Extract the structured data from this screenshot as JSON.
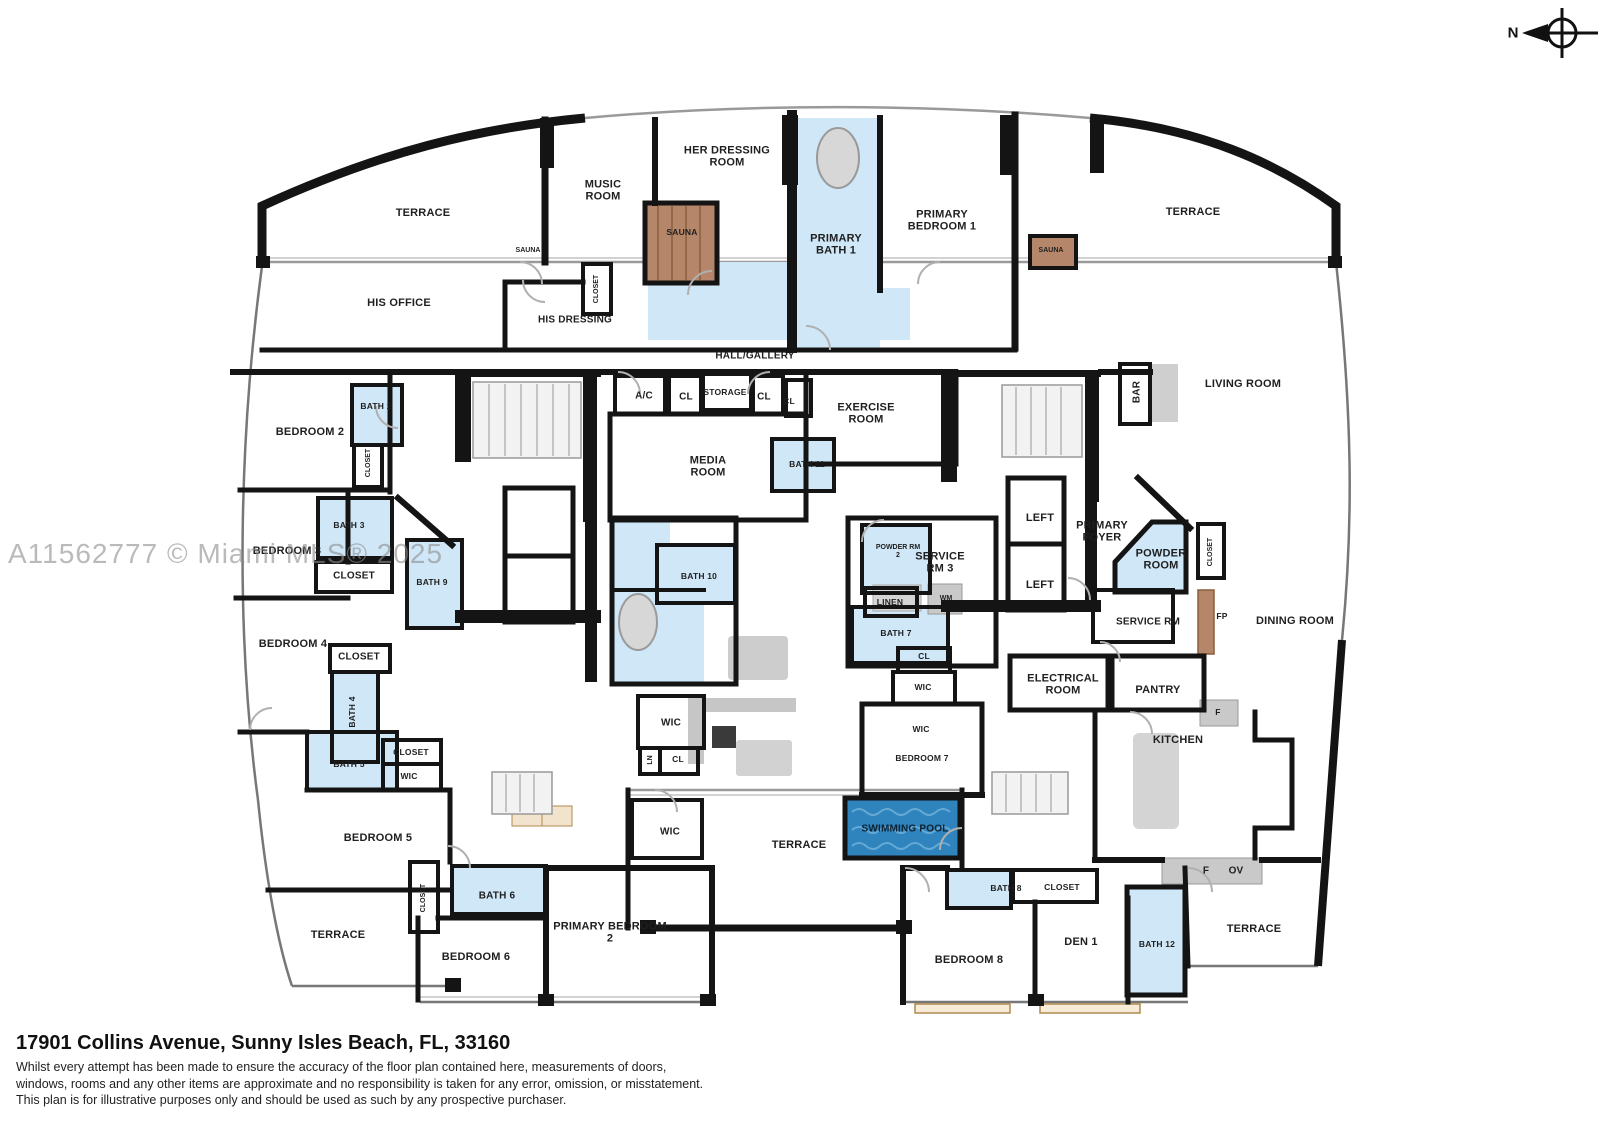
{
  "watermark": "A11562777 © Miami MLS® 2025",
  "compass": {
    "north_label": "N"
  },
  "footer": {
    "address": "17901 Collins Avenue, Sunny Isles Beach, FL, 33160",
    "disclaimer_line1": "Whilst every attempt has been made to ensure the accuracy of the floor plan contained here, measurements of doors,",
    "disclaimer_line2": "windows, rooms and any other items are approximate and no responsibility is taken for any error, omission, or misstatement.",
    "disclaimer_line3": "This plan is for illustrative purposes only and should be used as such by any prospective purchaser."
  },
  "colors": {
    "wall": "#141414",
    "bath_blue": "#cfe7f7",
    "sauna_brown": "#b5866a",
    "pool_blue": "#2f84bd",
    "fixture_gray": "#c9c9c9",
    "wood_tan": "#c9a063"
  },
  "labels": {
    "terrace_top_left": "TERRACE",
    "music_room": "MUSIC ROOM",
    "her_dressing_room": "HER DRESSING ROOM",
    "sauna_center": "SAUNA",
    "primary_bath_1": "PRIMARY BATH 1",
    "primary_bedroom_1": "PRIMARY BEDROOM 1",
    "sauna_right": "SAUNA",
    "terrace_top_right": "TERRACE",
    "sauna_left": "SAUNA",
    "his_office": "HIS OFFICE",
    "closet_his_dressing": "CLOSET",
    "his_dressing": "HIS DRESSING",
    "hall_gallery": "HALL/GALLERY",
    "bedroom_2": "BEDROOM 2",
    "bath_2_small": "BATH 2",
    "closet_bedroom_2": "CLOSET",
    "ac": "A/C",
    "cl_1": "CL",
    "storage": "STORAGE",
    "cl_2": "CL",
    "cl_3": "CL",
    "exercise_room": "EXERCISE ROOM",
    "bar": "BAR",
    "living_room": "LIVING ROOM",
    "media_room": "MEDIA ROOM",
    "bath_11": "BATH 11",
    "bedroom_3": "BEDROOM 3",
    "bath_3": "BATH 3",
    "closet_bedroom_3": "CLOSET",
    "bath_9": "BATH 9",
    "bath_10": "BATH 10",
    "powder_rm_2": "POWDER RM 2",
    "service_rm_3": "SERVICE RM 3",
    "lift_upper": "LEFT",
    "primary_foyer": "PRIMARY FOYER",
    "lift_lower": "LEFT",
    "powder_room": "POWDER ROOM",
    "closet_powder": "CLOSET",
    "bedroom_4": "BEDROOM 4",
    "closet_bedroom_4": "CLOSET",
    "linen": "LINEN",
    "wm": "WM",
    "bath_7": "BATH 7",
    "service_rm": "SERVICE RM",
    "fp": "FP",
    "dining_room": "DINING ROOM",
    "bath_4": "BATH 4",
    "cl_bath_7": "CL",
    "wic_service": "WIC",
    "electrical_room": "ELECTRICAL ROOM",
    "pantry": "PANTRY",
    "bath_5": "BATH 5",
    "closet_bedroom_5": "CLOSET",
    "wic_bedroom_5": "WIC",
    "wic_center_upper": "WIC",
    "ln_center": "LN",
    "cl_center": "CL",
    "wic_bedroom_7": "WIC",
    "bedroom_7": "BEDROOM 7",
    "kitchen": "KITCHEN",
    "f_pantry": "F",
    "bedroom_5": "BEDROOM 5",
    "wic_center_lower": "WIC",
    "terrace_center": "TERRACE",
    "swimming_pool": "SWIMMING POOL",
    "terrace_bottom_left": "TERRACE",
    "closet_bedroom_6": "CLOSET",
    "bath_6": "BATH 6",
    "bedroom_6": "BEDROOM 6",
    "primary_bedroom_2": "PRIMARY BEDROOM 2",
    "f_kitchen": "F",
    "ov_kitchen": "OV",
    "bath_8": "BATH 8",
    "closet_bedroom_8": "CLOSET",
    "den_1": "DEN 1",
    "bedroom_8": "BEDROOM 8",
    "bath_12": "BATH 12",
    "terrace_bottom_right": "TERRACE"
  }
}
